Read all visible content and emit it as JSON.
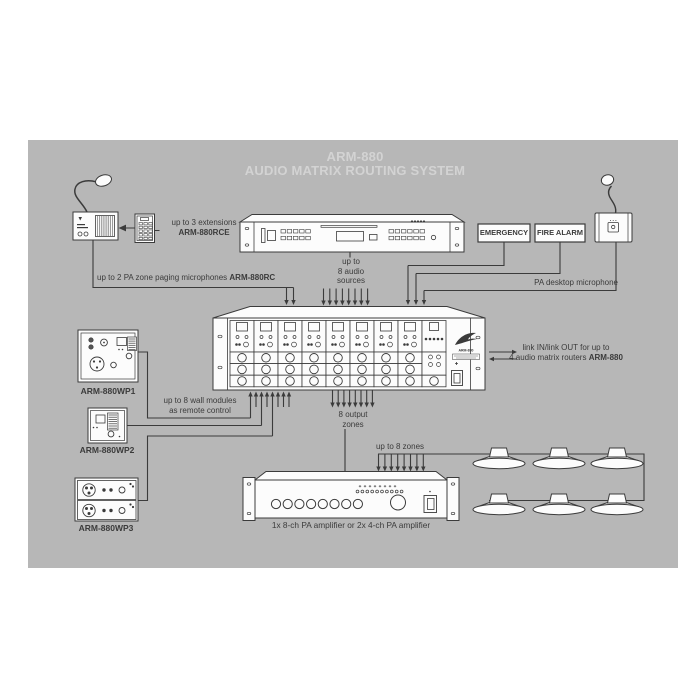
{
  "page": {
    "background": "#ffffff",
    "panel_background": "#b7b7b7",
    "line_color": "#3b3b3b",
    "device_fill": "#fcfcfc",
    "title_color": "#d3d3d3"
  },
  "title": {
    "line1": "ARM-880",
    "line2": "AUDIO MATRIX ROUTING SYSTEM"
  },
  "labels": {
    "extensions": {
      "line1": "up to 3 extensions",
      "line2": "ARM-880RCE"
    },
    "paging": {
      "text": "up to 2 PA zone paging microphones",
      "model": "ARM-880RC"
    },
    "sources": {
      "line1": "up to",
      "line2": "8 audio",
      "line3": "sources"
    },
    "emergency": "EMERGENCY",
    "fire_alarm": "FIRE ALARM",
    "desktop_mic": "PA desktop microphone",
    "link": {
      "line1": "link IN/link OUT for up to",
      "line2": "4 audio matrix routers",
      "model": "ARM-880"
    },
    "wall_modules": {
      "line1": "up to 8 wall modules",
      "line2": "as remote control"
    },
    "wp1": "ARM-880WP1",
    "wp2": "ARM-880WP2",
    "wp3": "ARM-880WP3",
    "output_zones": {
      "line1": "8 output",
      "line2": "zones"
    },
    "zones": "up to 8 zones",
    "amplifier": "1x 8-ch PA amplifier or 2x 4-ch PA amplifier",
    "matrix_model": "ARM-880"
  },
  "counts": {
    "matrix_channels": 8,
    "paging_arrows": 2,
    "source_arrows": 8,
    "alarm_mic_arrows": 3,
    "wall_arrows": 8,
    "output_arrows": 8,
    "zone_arrows": 8,
    "amp_knobs": 8,
    "amp_leds": 10,
    "speaker_rows": 2,
    "speakers_per_row": 3
  }
}
